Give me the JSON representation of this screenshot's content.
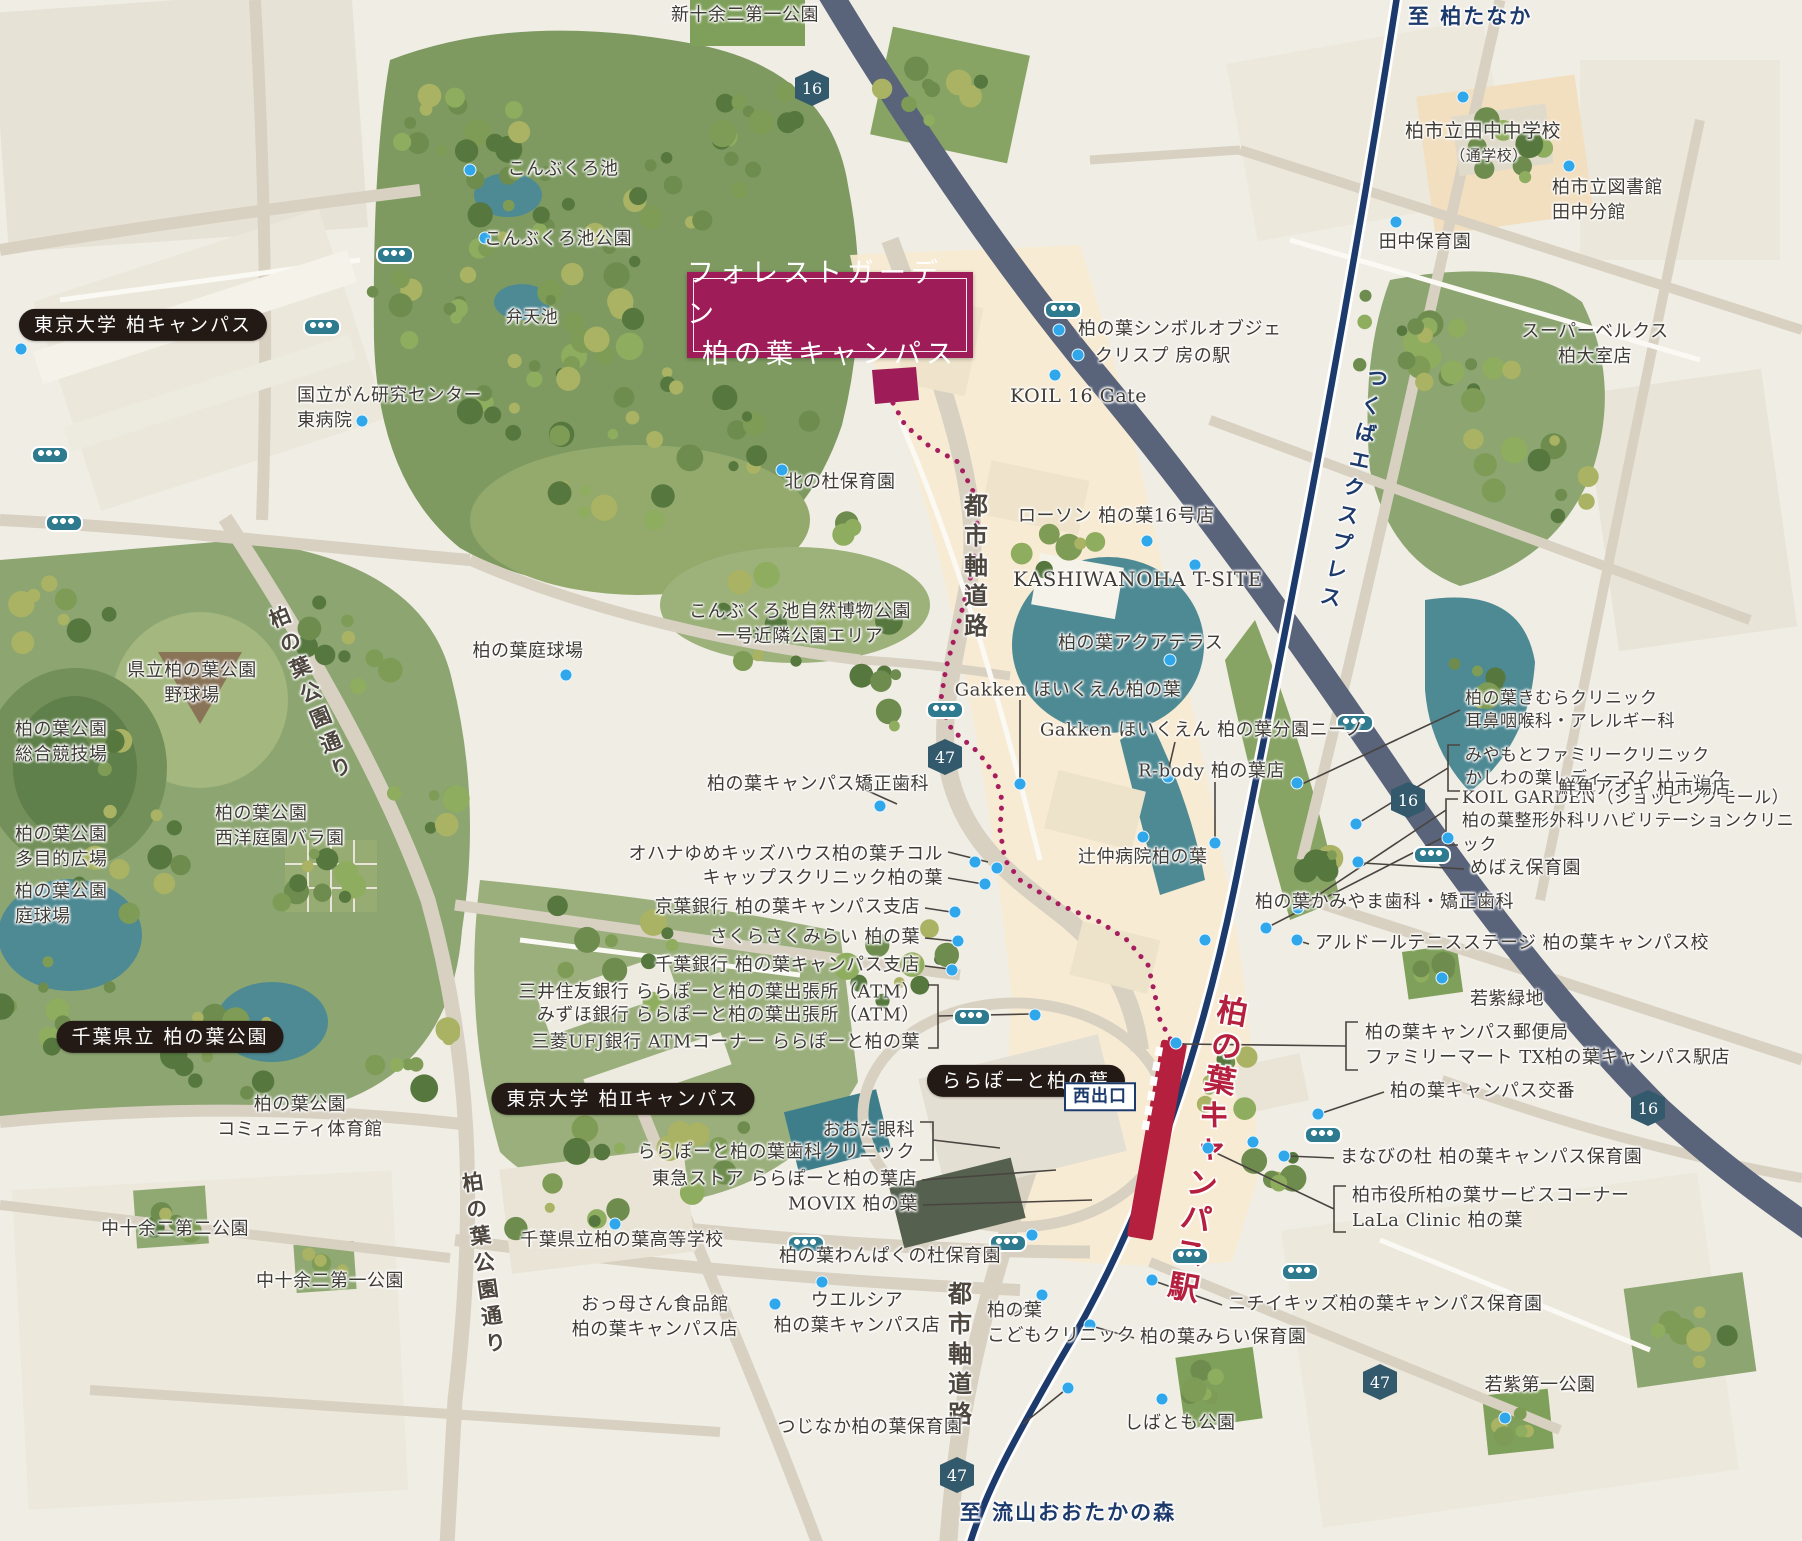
{
  "title": {
    "line1": "フォレストガーデン",
    "line2": "柏の葉キャンパス"
  },
  "station": {
    "name": "柏の葉キャンパス駅",
    "exit": "西出口"
  },
  "colors": {
    "accent_magenta": "#9E1D59",
    "rail_navy": "#1D3A6C",
    "station_red": "#B5203F",
    "route16_road": "#59637A",
    "water_teal": "#4E8A94",
    "bus_teal": "#2E7A8E",
    "poi_dot_blue": "#2FA7EA",
    "shield": "#33596C",
    "text": "#3F3B35",
    "pill_black": "#241A15",
    "park_green": "#8CA571",
    "bg_cream": "#F0EDE5",
    "district_peach": "#F8EAD1"
  },
  "route_shields": [
    {
      "num": "16",
      "x": 812,
      "y": 88
    },
    {
      "num": "47",
      "x": 945,
      "y": 757
    },
    {
      "num": "16",
      "x": 1408,
      "y": 800
    },
    {
      "num": "16",
      "x": 1648,
      "y": 1108
    },
    {
      "num": "47",
      "x": 957,
      "y": 1475
    },
    {
      "num": "47",
      "x": 1380,
      "y": 1382
    }
  ],
  "bus_stops": [
    [
      395,
      255
    ],
    [
      322,
      327
    ],
    [
      50,
      455
    ],
    [
      64,
      523
    ],
    [
      1063,
      310
    ],
    [
      945,
      710
    ],
    [
      1355,
      723
    ],
    [
      1432,
      855
    ],
    [
      1323,
      1135
    ],
    [
      972,
      1017
    ],
    [
      806,
      1244
    ],
    [
      1008,
      1243
    ],
    [
      1190,
      1256
    ],
    [
      1300,
      1272
    ]
  ],
  "poi_dots": [
    [
      21,
      349
    ],
    [
      470,
      170
    ],
    [
      485,
      238
    ],
    [
      362,
      421
    ],
    [
      1463,
      97
    ],
    [
      1569,
      166
    ],
    [
      1396,
      222
    ],
    [
      1059,
      330
    ],
    [
      1078,
      355
    ],
    [
      1055,
      375
    ],
    [
      1147,
      541
    ],
    [
      1195,
      565
    ],
    [
      1170,
      660
    ],
    [
      1020,
      784
    ],
    [
      1168,
      777
    ],
    [
      1215,
      843
    ],
    [
      1143,
      837
    ],
    [
      1448,
      838
    ],
    [
      1358,
      862
    ],
    [
      566,
      675
    ],
    [
      880,
      806
    ],
    [
      975,
      862
    ],
    [
      985,
      884
    ],
    [
      955,
      912
    ],
    [
      958,
      941
    ],
    [
      952,
      970
    ],
    [
      1035,
      1015
    ],
    [
      1176,
      1043
    ],
    [
      1318,
      1114
    ],
    [
      1253,
      1142
    ],
    [
      1284,
      1156
    ],
    [
      1208,
      1148
    ],
    [
      1152,
      1280
    ],
    [
      1090,
      1325
    ],
    [
      1042,
      1295
    ],
    [
      1068,
      1388
    ],
    [
      1162,
      1399
    ],
    [
      1505,
      1418
    ],
    [
      1442,
      978
    ],
    [
      1032,
      1235
    ],
    [
      822,
      1282
    ],
    [
      775,
      1304
    ],
    [
      615,
      1224
    ],
    [
      1297,
      940
    ],
    [
      1205,
      940
    ],
    [
      1298,
      908
    ],
    [
      1266,
      928
    ],
    [
      1356,
      824
    ],
    [
      1297,
      783
    ],
    [
      782,
      470
    ],
    [
      997,
      868
    ]
  ],
  "labels": [
    {
      "t": "新十余二第一公園",
      "x": 745,
      "y": 16
    },
    {
      "t": "至 柏たなか",
      "x": 1408,
      "y": 17,
      "cls": "dest",
      "ta": "left"
    },
    {
      "t": "こんぶくろ池",
      "x": 563,
      "y": 170
    },
    {
      "t": "こんぶくろ池公園",
      "x": 558,
      "y": 240
    },
    {
      "t": "柏市立田中中学校",
      "x": 1483,
      "y": 131,
      "s": 19
    },
    {
      "t": "（通学校）",
      "x": 1489,
      "y": 156,
      "s": 15
    },
    {
      "t": "柏市立図書館\n田中分館",
      "x": 1552,
      "y": 201,
      "ta": "left"
    },
    {
      "t": "田中保育園",
      "x": 1425,
      "y": 243
    },
    {
      "t": "東京大学 柏キャンパス",
      "x": 143,
      "y": 325,
      "cls": "pill"
    },
    {
      "t": "国立がん研究センター\n東病院",
      "x": 297,
      "y": 409,
      "ta": "left"
    },
    {
      "t": "スーパーベルクス\n柏大室店",
      "x": 1595,
      "y": 345
    },
    {
      "t": "柏の葉シンボルオブジェ",
      "x": 1078,
      "y": 330,
      "ta": "left"
    },
    {
      "t": "クリスプ 房の駅",
      "x": 1095,
      "y": 357,
      "ta": "left"
    },
    {
      "t": "KOIL 16 Gate",
      "x": 1010,
      "y": 396,
      "ta": "left",
      "s": 19
    },
    {
      "t": "弁天池",
      "x": 532,
      "y": 318,
      "s": 17
    },
    {
      "t": "北の杜保育園",
      "x": 840,
      "y": 483
    },
    {
      "t": "ローソン 柏の葉16号店",
      "x": 1018,
      "y": 517,
      "ta": "left"
    },
    {
      "t": "都市軸道路",
      "x": 974,
      "y": 568,
      "cls": "roadv",
      "s": 24
    },
    {
      "t": "KASHIWANOHA T-SITE",
      "x": 1013,
      "y": 580,
      "ta": "left",
      "s": 20
    },
    {
      "t": "つくばエクスプレス",
      "x": 1352,
      "y": 490,
      "cls": "railname",
      "rot": 12,
      "s": 21
    },
    {
      "t": "柏の葉アクアテラス",
      "x": 1058,
      "y": 644,
      "ta": "left"
    },
    {
      "t": "こんぶくろ池自然博物公園\n一号近隣公園エリア",
      "x": 800,
      "y": 625
    },
    {
      "t": "柏の葉庭球場",
      "x": 528,
      "y": 652
    },
    {
      "t": "県立柏の葉公園\n野球場",
      "x": 192,
      "y": 684
    },
    {
      "t": "柏の葉公園通り",
      "x": 310,
      "y": 695,
      "cls": "roadv",
      "rot": -22,
      "s": 21
    },
    {
      "t": "Gakken ほいくえん柏の葉",
      "x": 1068,
      "y": 691
    },
    {
      "t": "柏の葉きむらクリニック\n耳鼻咽喉科・アレルギー科",
      "x": 1465,
      "y": 711,
      "ta": "left",
      "s": 17
    },
    {
      "t": "柏の葉公園\n総合競技場",
      "x": 15,
      "y": 743,
      "ta": "left"
    },
    {
      "t": "Gakken ほいくえん 柏の葉分園ニーノ",
      "x": 1040,
      "y": 731,
      "ta": "left"
    },
    {
      "t": "みやもとファミリークリニック\nかしわの葉レディースクリニック",
      "x": 1465,
      "y": 768,
      "ta": "left",
      "s": 17
    },
    {
      "t": "R-body 柏の葉店",
      "x": 1138,
      "y": 772,
      "ta": "left"
    },
    {
      "t": "KOIL GARDEN（ショッピングモール）\n柏の葉整形外科リハビリテーションクリニック",
      "x": 1462,
      "y": 822,
      "ta": "left",
      "s": 17
    },
    {
      "t": "柏の葉キャンパス矯正歯科",
      "x": 707,
      "y": 785,
      "ta": "left"
    },
    {
      "t": "オハナゆめキッズハウス柏の葉チコル",
      "x": 943,
      "y": 855,
      "ta": "right"
    },
    {
      "t": "キャップスクリニック柏の葉",
      "x": 943,
      "y": 879,
      "ta": "right"
    },
    {
      "t": "辻仲病院柏の葉",
      "x": 1078,
      "y": 858,
      "ta": "left"
    },
    {
      "t": "めばえ保育園",
      "x": 1470,
      "y": 869,
      "ta": "left"
    },
    {
      "t": "柏の葉公園\n西洋庭園バラ園",
      "x": 215,
      "y": 827,
      "ta": "left"
    },
    {
      "t": "柏の葉公園\n多目的広場",
      "x": 15,
      "y": 848,
      "ta": "left"
    },
    {
      "t": "京葉銀行 柏の葉キャンパス支店",
      "x": 920,
      "y": 908,
      "ta": "right"
    },
    {
      "t": "鮮魚アオキ 柏市場店",
      "x": 1558,
      "y": 789,
      "ta": "left"
    },
    {
      "t": "さくらさくみらい 柏の葉",
      "x": 920,
      "y": 938,
      "ta": "right"
    },
    {
      "t": "柏の葉かみやま歯科・矯正歯科",
      "x": 1255,
      "y": 903,
      "ta": "left"
    },
    {
      "t": "千葉銀行 柏の葉キャンパス支店",
      "x": 920,
      "y": 966,
      "ta": "right"
    },
    {
      "t": "アルドールテニスステージ 柏の葉キャンパス校",
      "x": 1315,
      "y": 944,
      "ta": "left"
    },
    {
      "t": "三井住友銀行 ららぽーと柏の葉出張所（ATM）",
      "x": 920,
      "y": 993,
      "ta": "right"
    },
    {
      "t": "みずほ銀行 ららぽーと柏の葉出張所（ATM）",
      "x": 920,
      "y": 1016,
      "ta": "right"
    },
    {
      "t": "三菱UFJ銀行 ATMコーナー ららぽーと柏の葉",
      "x": 920,
      "y": 1043,
      "ta": "right"
    },
    {
      "t": "柏の葉公園\n庭球場",
      "x": 15,
      "y": 905,
      "ta": "left"
    },
    {
      "t": "若紫緑地",
      "x": 1470,
      "y": 1000,
      "ta": "left"
    },
    {
      "t": "千葉県立 柏の葉公園",
      "x": 170,
      "y": 1037,
      "cls": "pill"
    },
    {
      "t": "柏の葉キャンパス郵便局\nファミリーマート TX柏の葉キャンパス駅店",
      "x": 1365,
      "y": 1046,
      "ta": "left"
    },
    {
      "t": "ららぽーと柏の葉",
      "x": 1026,
      "y": 1081,
      "cls": "pill"
    },
    {
      "t": "柏の葉キャンパス交番",
      "x": 1390,
      "y": 1092,
      "ta": "left"
    },
    {
      "t": "柏の葉公園\nコミュニティ体育館",
      "x": 300,
      "y": 1118
    },
    {
      "t": "まなびの杜 柏の葉キャンパス保育園",
      "x": 1340,
      "y": 1158,
      "ta": "left"
    },
    {
      "t": "東京大学 柏Ⅱキャンパス",
      "x": 623,
      "y": 1099,
      "cls": "pill"
    },
    {
      "t": "おおた眼科",
      "x": 915,
      "y": 1131,
      "ta": "right"
    },
    {
      "t": "ららぽーと柏の葉歯科クリニック",
      "x": 915,
      "y": 1153,
      "ta": "right"
    },
    {
      "t": "東急ストア ららぽーと柏の葉店",
      "x": 917,
      "y": 1180,
      "ta": "right"
    },
    {
      "t": "MOVIX 柏の葉",
      "x": 918,
      "y": 1205,
      "ta": "right"
    },
    {
      "t": "柏市役所柏の葉サービスコーナー\nLaLa Clinic 柏の葉",
      "x": 1352,
      "y": 1209,
      "ta": "left"
    },
    {
      "t": "千葉県立柏の葉高等学校",
      "x": 622,
      "y": 1241
    },
    {
      "t": "柏の葉わんぱくの杜保育園",
      "x": 890,
      "y": 1257
    },
    {
      "t": "中十余二第二公園",
      "x": 175,
      "y": 1230
    },
    {
      "t": "中十余二第一公園",
      "x": 330,
      "y": 1282
    },
    {
      "t": "柏の葉公園通り",
      "x": 483,
      "y": 1265,
      "cls": "roadv",
      "rot": -8,
      "s": 21
    },
    {
      "t": "おっ母さん食品館\n柏の葉キャンパス店",
      "x": 655,
      "y": 1318
    },
    {
      "t": "ウエルシア\n柏の葉キャンパス店",
      "x": 857,
      "y": 1314
    },
    {
      "t": "都市軸道路",
      "x": 958,
      "y": 1356,
      "cls": "roadv",
      "s": 24
    },
    {
      "t": "柏の葉\nこどもクリニック",
      "x": 987,
      "y": 1324,
      "ta": "left"
    },
    {
      "t": "ニチイキッズ柏の葉キャンパス保育園",
      "x": 1228,
      "y": 1305,
      "ta": "left"
    },
    {
      "t": "柏の葉みらい保育園",
      "x": 1140,
      "y": 1338,
      "ta": "left"
    },
    {
      "t": "つじなか柏の葉保育園",
      "x": 870,
      "y": 1428
    },
    {
      "t": "しばとも公園",
      "x": 1180,
      "y": 1424
    },
    {
      "t": "若紫第一公園",
      "x": 1540,
      "y": 1386
    },
    {
      "t": "至 流山おおたかの森",
      "x": 1068,
      "y": 1513,
      "cls": "dest"
    }
  ]
}
